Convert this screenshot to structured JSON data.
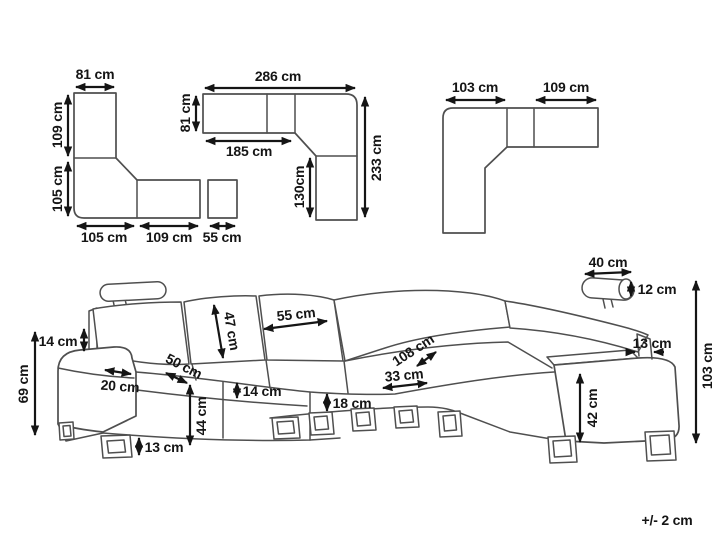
{
  "doc": {
    "title": "Corner sofa dimension diagram",
    "tolerance": "+/- 2 cm",
    "colors": {
      "outline": "#4f4f4f",
      "dimension": "#151515",
      "background": "#ffffff"
    }
  },
  "top_views": {
    "left": {
      "top": "81 cm",
      "side_upper": "109 cm",
      "side_lower": "105 cm",
      "bottom_left": "105 cm",
      "bottom_mid": "109 cm",
      "bottom_right": "55 cm"
    },
    "middle": {
      "top": "286 cm",
      "side": "81 cm",
      "inner_bottom": "185 cm",
      "inner_right": "130cm",
      "right": "233 cm"
    },
    "right": {
      "top_left": "103 cm",
      "top_right": "109 cm"
    }
  },
  "sofa": {
    "headrest_height": "14 cm",
    "arm_floor_height": "69 cm",
    "arm_width": "20 cm",
    "seat_depth": "50 cm",
    "backrest_height": "47 cm",
    "leg_height": "13 cm",
    "seat_floor_height": "44 cm",
    "seat_thickness": "14 cm",
    "back_cushion_width": "55 cm",
    "clearance": "18 cm",
    "corner_seat_width": "33 cm",
    "corner_diagonal": "108 cm",
    "headrest_width": "40 cm",
    "headrest_depth": "12 cm",
    "backrest_thickness": "13 cm",
    "armrest_height": "42 cm",
    "total_height": "103 cm"
  }
}
